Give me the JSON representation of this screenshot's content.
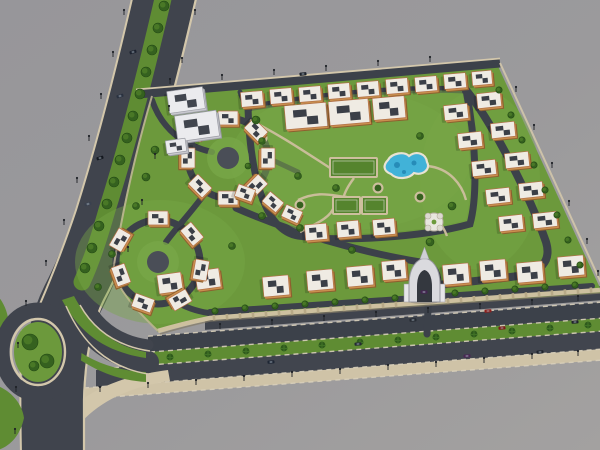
{
  "scene": {
    "description": "Aerial 3D rendering of a walled residential compound with central park, lagoon pool, sports courts, apartment blocks, white tower, entrance gate, boulevard and palm-lined main road",
    "width": 600,
    "height": 450
  },
  "colors": {
    "bg1": "#97969a",
    "bg2": "#a3a1a0",
    "bgLow": "#9a999a",
    "road": "#40444d",
    "road2": "#3c414a",
    "roadDark": "#34383f",
    "curb": "#d3c7ab",
    "curbLine": "#d8cfba",
    "lawn": "#6c993c",
    "lawnLight": "#78a647",
    "medianGreen": "#5f8c33",
    "parkPath": "#cdbf9e",
    "wall": "#cdc09f",
    "wallPost": "#b7a987",
    "wallShadow": "#837a66",
    "court": "#55842e",
    "courtLine": "#cfd8c2",
    "pool": "#41b2d8",
    "poolDeep": "#1d7fae",
    "poolRim": "#e9e3d3",
    "treeDark": "#35611f",
    "treeLight": "#4c7c28",
    "palm": "#2e5a1c",
    "palmLeaf": "#477a2a",
    "bldSide": "#8e5f2e",
    "bldFront": "#c98f4f",
    "bldRoof": "#efebe3",
    "bldTrim": "#b27047",
    "bldTop": "#3b3f47",
    "twrSide": "#9b9ca4",
    "twrFront": "#c9c9cf",
    "twrRoof": "#ebebee",
    "twrTop": "#41454e",
    "gateWhite": "#dadade",
    "gateDark": "#34383f",
    "gateEdge": "#97979f",
    "lamp": "#1e2126",
    "shadow": "#000000"
  },
  "bands": {
    "slope": -0.075,
    "x0": 150,
    "xEnd": 600,
    "items": [
      {
        "xL": 205,
        "y": 320,
        "h": 14,
        "fill": "#40444d"
      },
      {
        "xL": 148,
        "y": 336,
        "h": 16,
        "fill": "#3c414a"
      },
      {
        "xL": 150,
        "y": 352,
        "h": 13,
        "fill": "#5f8c33"
      },
      {
        "xL": 96,
        "y": 365,
        "h": 18,
        "fill": "#41454e"
      },
      {
        "xL": 84,
        "y": 383,
        "h": 11,
        "fill": "#cfc3a7"
      }
    ],
    "dashes": [
      [
        205,
        322
      ],
      [
        148,
        336
      ],
      [
        150,
        352
      ],
      [
        96,
        365
      ],
      [
        84,
        383
      ],
      [
        84,
        394
      ]
    ]
  },
  "sidewalkArc": "M170,381 C120,388 80,410 62,452 L45,452 C60,402 105,378 168,370 Z",
  "boulevard": {
    "band": "M166,-10 C150,60 130,140 108,210 C95,250 85,275 72,300 C59,326 53,360 52,400 L52,455",
    "bandW": 62,
    "median": "M165,-10 C149,60 129,140 107,210 C99,238 92,260 82,282",
    "medianW": 17,
    "leftCurb": "M134,-10 C118,60 98,140 76,210 C64,246 52,276 40,304",
    "leftCurb2": "M22,330 C20,362 20,404 21,455",
    "rightCurb": "M198,-10 C182,60 162,140 140,210 C127,250 117,276 104,300 C91,326 85,360 84,400 L84,455"
  },
  "branchRoads": [
    {
      "d": "M148,362 C108,356 84,334 70,300",
      "w": 22
    },
    {
      "d": "M148,345 C118,341 98,326 86,302",
      "w": 11
    }
  ],
  "branchCurbs": [
    {
      "d": "M150,351 C116,346 94,330 80,305",
      "w": 1.5
    },
    {
      "d": "M148,374 C106,367 82,342 66,306",
      "w": 1.5
    }
  ],
  "greens": [
    "M62,300 C80,334 106,352 146,358 L146,352 C112,346 90,326 74,296 Z",
    "M74,348 C96,364 120,371 146,372 L146,382 C112,380 88,366 70,353 Z",
    "M-2,386 C12,392 22,404 24,418 C20,436 10,446 -2,450 Z",
    "M-2,296 C6,306 10,318 8,332 L-2,338 Z"
  ],
  "island": {
    "cx": 38,
    "cy": 352,
    "rxRoad": 36,
    "ryRoad": 42,
    "rxCurb": 27,
    "ryCurb": 33,
    "rx": 24,
    "ry": 30,
    "trees": [
      [
        30,
        342,
        8
      ],
      [
        47,
        361,
        7
      ],
      [
        34,
        366,
        5
      ]
    ]
  },
  "compound": {
    "outline": "M152,95 L497,64 L600,288 L600,293 L210,320 C185,325 166,330 158,332 C135,310 118,292 112,272 C118,230 132,160 152,95 Z",
    "patches": [
      [
        350,
        160,
        120,
        70
      ],
      [
        160,
        262,
        85,
        62
      ],
      [
        480,
        180,
        60,
        90
      ]
    ],
    "topRoad": {
      "d": "M138,94 L500,63",
      "w": 9
    },
    "topCurb": "M136,89.5 L500,58.5",
    "rightCurb": "M500,63 L603,287",
    "wall": "M600,290 L210,318 C186,323 168,328 158,331",
    "wallShadow": "M600,293 L210,321 C188,326 170,331 160,334",
    "wallPosts": {
      "xStart": 214,
      "xEnd": 592,
      "step": 13,
      "yAt210": 318,
      "slope": -0.0727,
      "gapX1": 406,
      "gapX2": 446
    },
    "leftWall": "M158,331 C136,310 120,292 113,272 C119,230 133,160 152,96"
  },
  "innerRoads": [
    {
      "d": "M248,108 C320,95 400,87 466,90 C476,140 478,195 470,224 C420,238 340,242 298,236 C262,230 250,168 248,108 Z",
      "w": 7
    },
    {
      "d": "M466,90 C492,122 530,196 546,242 C552,262 540,272 518,276 C490,280 462,282 438,285",
      "w": 8
    },
    {
      "d": "M429,283 L427,334",
      "w": 7
    },
    {
      "d": "M152,100 C162,130 185,146 212,152",
      "w": 6
    },
    {
      "d": "M206,192 C190,214 176,228 166,242",
      "w": 6
    },
    {
      "d": "M175,301 C196,314 220,316 246,313",
      "w": 6
    },
    {
      "d": "M210,312 L592,286",
      "w": 6
    },
    {
      "d": "M236,208 C290,232 360,252 420,262 C432,264 438,270 438,283",
      "w": 7
    },
    {
      "d": "M268,158 L298,172",
      "w": 5
    },
    {
      "d": "M240,92 L245,106",
      "w": 5
    }
  ],
  "clusterRoads": [
    [
      228,
      158,
      40
    ],
    [
      158,
      262,
      42
    ]
  ],
  "clusterCenters": [
    [
      228,
      158
    ],
    [
      158,
      262
    ]
  ],
  "park": {
    "fill": "M252,108 C320,96 400,88 462,91 C471,140 473,192 466,220 C420,233 344,237 303,231 C268,225 253,168 252,108 Z",
    "paths": [
      "M250,120 C280,135 302,150 330,168",
      "M427,166 C450,168 462,185 466,200",
      "M300,232 C320,222 332,216 334,206",
      "M298,200 C320,190 332,196 347,197",
      "M434,215 C440,222 444,228 447,236",
      "M354,178 C342,194 340,204 347,214"
    ],
    "courts": [
      [
        330,
        158,
        47,
        19
      ],
      [
        333,
        197,
        27,
        17
      ],
      [
        362,
        197,
        25,
        17
      ]
    ],
    "pool": {
      "d": "M388,160 C392,153 404,151 409,156 C417,150 426,154 427,162 C431,169 423,176 414,173 C409,179 397,180 391,174 C383,171 383,165 388,160 Z",
      "spots": [
        [
          397,
          165,
          3
        ],
        [
          414,
          163,
          2.5
        ],
        [
          404,
          172,
          2
        ]
      ]
    },
    "planters": [
      [
        378,
        188
      ],
      [
        420,
        197
      ],
      [
        300,
        205
      ],
      [
        262,
        138
      ]
    ],
    "gazebo": {
      "x": 434,
      "y": 222
    }
  },
  "buildings": [
    [
      252,
      99,
      22,
      15,
      -5
    ],
    [
      281,
      96,
      22,
      15,
      -5
    ],
    [
      310,
      94,
      22,
      15,
      -5
    ],
    [
      339,
      91,
      22,
      15,
      -5
    ],
    [
      368,
      89,
      22,
      15,
      -5
    ],
    [
      397,
      86,
      22,
      15,
      -5
    ],
    [
      426,
      84,
      22,
      15,
      -5
    ],
    [
      455,
      81,
      22,
      15,
      -5
    ],
    [
      482,
      78,
      20,
      14,
      -5
    ],
    [
      306,
      116,
      42,
      24,
      -5
    ],
    [
      349,
      112,
      40,
      24,
      -5
    ],
    [
      389,
      108,
      32,
      22,
      -5
    ],
    [
      456,
      112,
      24,
      15,
      -6
    ],
    [
      470,
      140,
      24,
      15,
      -6
    ],
    [
      484,
      168,
      24,
      15,
      -6
    ],
    [
      498,
      196,
      24,
      15,
      -6
    ],
    [
      511,
      223,
      24,
      15,
      -6
    ],
    [
      489,
      100,
      24,
      15,
      -6
    ],
    [
      503,
      130,
      24,
      15,
      -6
    ],
    [
      517,
      160,
      24,
      15,
      -6
    ],
    [
      531,
      190,
      24,
      15,
      -6
    ],
    [
      545,
      220,
      24,
      15,
      -6
    ],
    [
      170,
      283,
      24,
      19,
      -8
    ],
    [
      208,
      279,
      24,
      19,
      -8
    ],
    [
      276,
      286,
      26,
      20,
      -5
    ],
    [
      320,
      280,
      26,
      20,
      -5
    ],
    [
      360,
      276,
      26,
      20,
      -5
    ],
    [
      394,
      270,
      24,
      19,
      -5
    ],
    [
      456,
      274,
      26,
      20,
      -5
    ],
    [
      493,
      270,
      26,
      20,
      -5
    ],
    [
      530,
      272,
      26,
      20,
      -5
    ],
    [
      571,
      266,
      26,
      20,
      -5
    ],
    [
      316,
      232,
      22,
      16,
      -5
    ],
    [
      348,
      229,
      22,
      16,
      -5
    ],
    [
      384,
      227,
      22,
      16,
      -5
    ],
    [
      228,
      118,
      20,
      14,
      0
    ],
    [
      256,
      130,
      20,
      14,
      45
    ],
    [
      268,
      158,
      20,
      14,
      90
    ],
    [
      256,
      186,
      20,
      14,
      135
    ],
    [
      228,
      198,
      20,
      14,
      0
    ],
    [
      200,
      186,
      20,
      14,
      45
    ],
    [
      188,
      158,
      20,
      14,
      90
    ],
    [
      200,
      130,
      20,
      14,
      -45
    ],
    [
      158,
      218,
      20,
      14,
      0
    ],
    [
      192,
      234,
      20,
      14,
      50
    ],
    [
      201,
      270,
      20,
      14,
      100
    ],
    [
      180,
      300,
      20,
      14,
      150
    ],
    [
      143,
      303,
      20,
      14,
      20
    ],
    [
      121,
      275,
      20,
      14,
      70
    ],
    [
      120,
      240,
      20,
      14,
      -60
    ],
    [
      245,
      193,
      18,
      13,
      20
    ],
    [
      273,
      202,
      18,
      13,
      40
    ],
    [
      292,
      214,
      18,
      13,
      25
    ]
  ],
  "tower": {
    "slabs": [
      [
        186,
        100,
        36,
        22,
        -8
      ],
      [
        197,
        126,
        42,
        26,
        -8
      ],
      [
        176,
        146,
        20,
        13,
        -8
      ]
    ]
  },
  "gate": {
    "shadow": [
      424,
      301,
      16,
      3
    ],
    "outer": "M409,302 L409,285 C409,266 418,259 424.5,258 C431,259 440,266 440,285 L440,302 Z",
    "inner": "M417,302 L417,287 C417,275 421,271 424.5,270 C428,271 432,275 432,287 L432,302 Z",
    "fin": "M420,259 L424.5,247 L429,259 Z",
    "pylons": [
      [
        404,
        284,
        5,
        18
      ],
      [
        440,
        284,
        5,
        18
      ]
    ]
  },
  "trees": {
    "median": [
      [
        164,
        6
      ],
      [
        158,
        28
      ],
      [
        152,
        50
      ],
      [
        146,
        72
      ],
      [
        140,
        94
      ],
      [
        133,
        116
      ],
      [
        127,
        138
      ],
      [
        120,
        160
      ],
      [
        114,
        182
      ],
      [
        107,
        204
      ],
      [
        99,
        226
      ],
      [
        92,
        248
      ],
      [
        85,
        268
      ]
    ],
    "wallLine": [
      [
        215,
        311
      ],
      [
        245,
        308
      ],
      [
        275,
        306
      ],
      [
        305,
        304
      ],
      [
        335,
        302
      ],
      [
        365,
        300
      ],
      [
        395,
        298
      ],
      [
        425,
        296
      ],
      [
        455,
        293
      ],
      [
        485,
        291
      ],
      [
        515,
        289
      ],
      [
        545,
        287
      ],
      [
        575,
        285
      ]
    ],
    "rightEdge": [
      [
        499,
        90
      ],
      [
        511,
        115
      ],
      [
        522,
        140
      ],
      [
        534,
        165
      ],
      [
        545,
        190
      ],
      [
        557,
        215
      ],
      [
        568,
        240
      ],
      [
        580,
        265
      ]
    ],
    "park": [
      [
        256,
        120,
        4
      ],
      [
        262,
        141,
        3.5
      ],
      [
        298,
        176,
        3.5
      ],
      [
        336,
        188,
        3.5
      ],
      [
        420,
        136,
        3.5
      ],
      [
        452,
        206,
        4
      ],
      [
        300,
        228,
        3.5
      ],
      [
        262,
        216,
        3.5
      ],
      [
        430,
        242,
        4
      ],
      [
        352,
        250,
        3.5
      ],
      [
        232,
        246,
        3.5
      ],
      [
        155,
        150,
        4
      ],
      [
        146,
        177,
        4
      ],
      [
        136,
        206,
        3.5
      ],
      [
        112,
        254,
        3.5
      ],
      [
        98,
        287,
        3.5
      ],
      [
        248,
        166,
        3
      ]
    ]
  },
  "palms": [
    [
      170,
      357
    ],
    [
      208,
      354
    ],
    [
      246,
      351
    ],
    [
      284,
      348
    ],
    [
      322,
      345
    ],
    [
      360,
      342
    ],
    [
      398,
      340
    ],
    [
      436,
      337
    ],
    [
      474,
      334
    ],
    [
      512,
      331
    ],
    [
      550,
      328
    ],
    [
      588,
      325
    ]
  ],
  "lamps": [
    [
      124,
      15
    ],
    [
      113,
      57
    ],
    [
      101,
      99
    ],
    [
      89,
      141
    ],
    [
      77,
      183
    ],
    [
      64,
      225
    ],
    [
      46,
      266
    ],
    [
      26,
      306
    ],
    [
      18,
      348
    ],
    [
      16,
      392
    ],
    [
      15,
      434
    ],
    [
      195,
      15
    ],
    [
      182,
      63
    ],
    [
      169,
      111
    ],
    [
      155,
      159
    ],
    [
      142,
      205
    ],
    [
      128,
      252
    ],
    [
      170,
      84
    ],
    [
      222,
      80
    ],
    [
      274,
      75
    ],
    [
      326,
      71
    ],
    [
      378,
      66
    ],
    [
      430,
      62
    ],
    [
      516,
      92
    ],
    [
      534,
      130
    ],
    [
      552,
      168
    ],
    [
      569,
      206
    ],
    [
      587,
      244
    ],
    [
      598,
      276
    ],
    [
      220,
      329
    ],
    [
      272,
      325
    ],
    [
      324,
      321
    ],
    [
      376,
      317
    ],
    [
      428,
      313
    ],
    [
      480,
      309
    ],
    [
      532,
      305
    ],
    [
      578,
      301
    ],
    [
      100,
      392
    ],
    [
      148,
      388
    ],
    [
      196,
      385
    ],
    [
      244,
      381
    ],
    [
      292,
      377
    ],
    [
      340,
      374
    ],
    [
      388,
      370
    ],
    [
      436,
      367
    ],
    [
      484,
      363
    ],
    [
      532,
      359
    ],
    [
      578,
      356
    ]
  ],
  "cars": [
    [
      133,
      52,
      -17,
      "#1d2330"
    ],
    [
      120,
      96,
      -17,
      "#2a3240"
    ],
    [
      100,
      158,
      -17,
      "#14181f"
    ],
    [
      88,
      204,
      -17,
      "#3a414e"
    ],
    [
      303,
      74,
      -5,
      "#1c212a"
    ],
    [
      488,
      311,
      -4,
      "#8e201d"
    ],
    [
      502,
      328,
      -4,
      "#7e1b1a"
    ],
    [
      575,
      322,
      -4,
      "#20242c"
    ],
    [
      413,
      320,
      -4,
      "#262b33"
    ],
    [
      271,
      362,
      -4,
      "#1e2634"
    ],
    [
      424,
      292,
      0,
      "#432550"
    ],
    [
      467,
      356,
      -4,
      "#4a2754"
    ],
    [
      358,
      344,
      -4,
      "#242a34"
    ],
    [
      540,
      352,
      -4,
      "#1f242d"
    ]
  ]
}
